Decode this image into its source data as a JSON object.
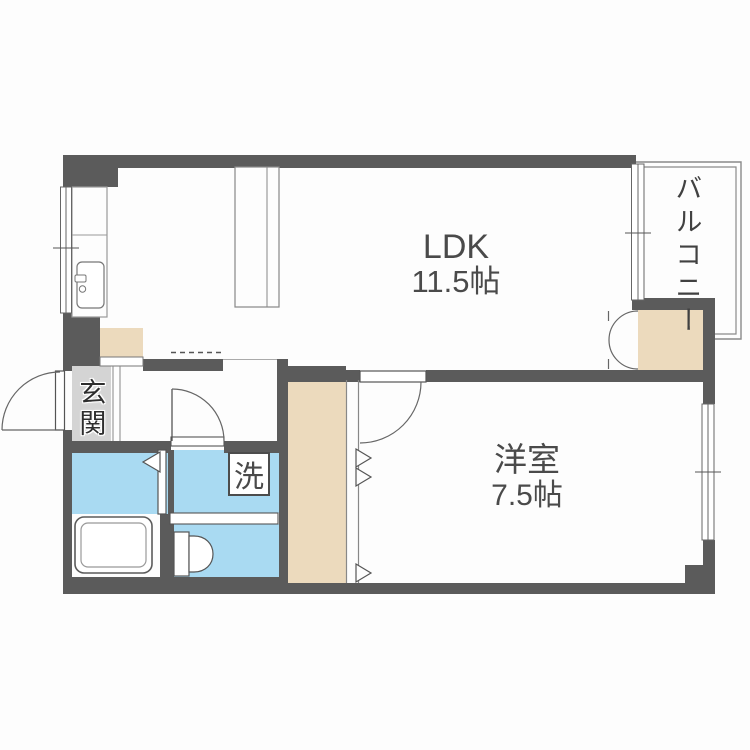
{
  "floorplan": {
    "rooms": {
      "ldk": {
        "name": "LDK",
        "size": "11.5帖"
      },
      "western_room": {
        "name": "洋室",
        "size": "7.5帖"
      },
      "balcony": {
        "name": "バルコニー"
      },
      "entrance": {
        "name": "玄関"
      }
    },
    "fixtures": {
      "washing_machine": "洗"
    },
    "colors": {
      "wall": "#5b5b5b",
      "water_area": "#a9daf2",
      "storage": "#ecdabd",
      "entrance_floor": "#d4d4d4",
      "background": "#fdfdfd",
      "text": "#4a4a4a"
    }
  }
}
